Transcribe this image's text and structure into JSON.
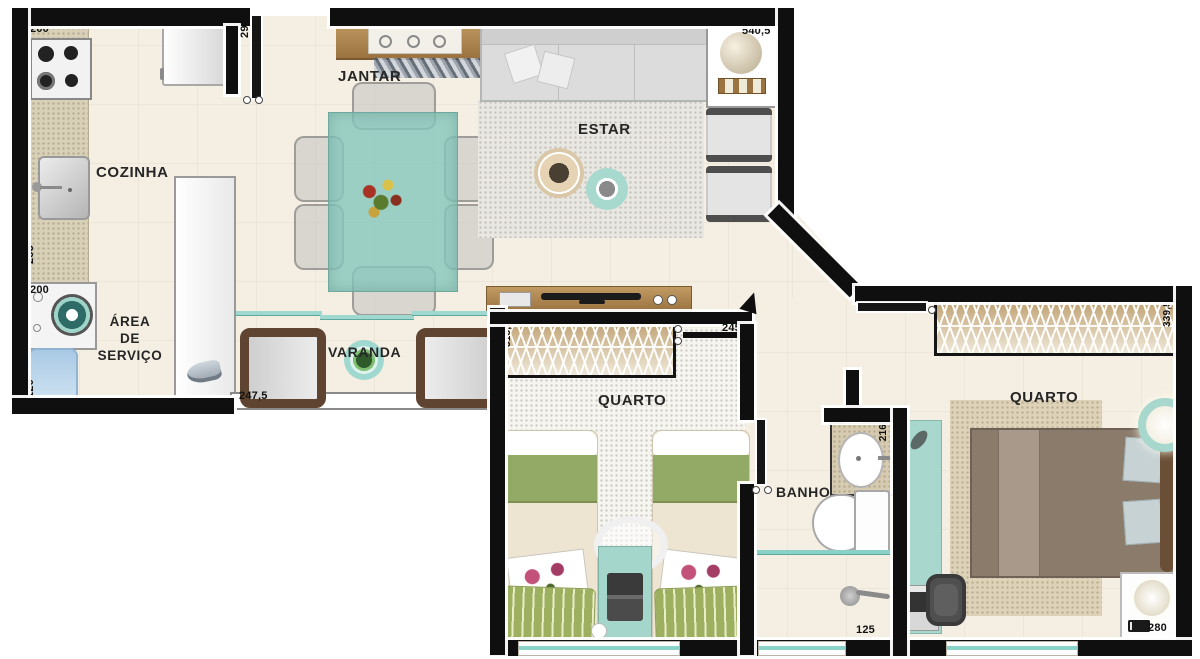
{
  "plan_title": "Apartment floor plan",
  "rooms": {
    "cozinha": "COZINHA",
    "jantar": "JANTAR",
    "estar": "ESTAR",
    "area_servico_1": "ÁREA",
    "area_servico_2": "DE",
    "area_servico_3": "SERVIÇO",
    "varanda": "VARANDA",
    "quarto1": "QUARTO",
    "banho": "BANHO",
    "quarto2": "QUARTO"
  },
  "dims": {
    "kitchen_top": "200",
    "entry_wall": "290",
    "kitchen_left": "253",
    "laundry": "200",
    "tank": "120",
    "varanda_width": "247,5",
    "estar_cabinet": "540,5",
    "quarto1_wardrobe": "318,5",
    "hall": "245",
    "quarto2_wardrobe": "339,5",
    "banho_vanity": "216",
    "banho_width": "125",
    "quarto2_window": "280"
  },
  "colors": {
    "wall": "#0f0f0f",
    "floor": "#f5efe3",
    "glass_teal": "#8ad1c8",
    "wood": "#b08a58",
    "bed_green": "#93a966",
    "desk_teal": "#a8d8cd"
  }
}
